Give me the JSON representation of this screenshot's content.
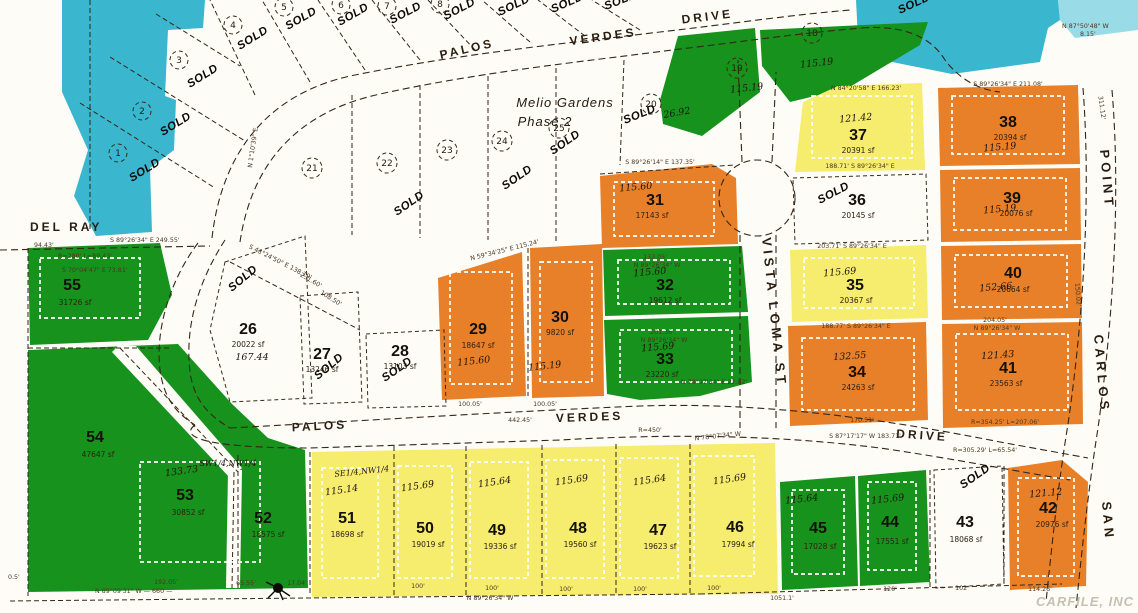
{
  "colors": {
    "water": "#3ab6ce",
    "water_light": "#9adbe8",
    "green": "#17921c",
    "yellow": "#f6ec6e",
    "orange": "#e8802a",
    "paper": "#fdfcf7"
  },
  "labels": {
    "sold": "SOLD",
    "melio1": "Melio Gardens",
    "melio2": "Phase 2",
    "q_sw": "SW1/4,NW1/4",
    "q_se": "SE1/4,NW1/4",
    "hand20": "26.92",
    "watermark": "CARFILE, INC"
  },
  "streets": {
    "top_palos": "PALOS",
    "top_verdes": "VERDES",
    "top_drive": "DRIVE",
    "del_ray": "DEL RAY",
    "mid_palos": "PALOS",
    "mid_verdes": "VERDES",
    "mid_drive": "DRIVE",
    "vista_loma": "VISTA LOMA ST",
    "san": "SAN",
    "carlos": "CARLOS",
    "point": "POINT"
  },
  "lots": [
    {
      "num": "26",
      "area": "20022 sf",
      "hand": "167.44",
      "sold": true
    },
    {
      "num": "27",
      "area": "13246 sf",
      "sold": true
    },
    {
      "num": "28",
      "area": "13103 sf",
      "sold": true
    },
    {
      "num": "29",
      "area": "18647 sf",
      "hand": "115.60"
    },
    {
      "num": "30",
      "area": "9820 sf",
      "hand": "115.19"
    },
    {
      "num": "31",
      "area": "17143 sf",
      "hand": "115.60"
    },
    {
      "num": "32",
      "area": "19612 sf",
      "hand": "115.60"
    },
    {
      "num": "33",
      "area": "23220 sf",
      "hand": "115.69"
    },
    {
      "num": "34",
      "area": "24263 sf",
      "hand": "132.55"
    },
    {
      "num": "35",
      "area": "20367 sf",
      "hand": "115.69"
    },
    {
      "num": "36",
      "area": "20145 sf",
      "sold": true
    },
    {
      "num": "37",
      "area": "20391 sf",
      "hand": "121.42"
    },
    {
      "num": "38",
      "area": "20394 sf",
      "hand": "115.19"
    },
    {
      "num": "39",
      "area": "20076 sf",
      "hand": "115.19"
    },
    {
      "num": "40",
      "area": "20664 sf",
      "hand": "152.66"
    },
    {
      "num": "41",
      "area": "23563 sf",
      "hand": "121.43"
    },
    {
      "num": "42",
      "area": "20976 sf",
      "hand": "121.12"
    },
    {
      "num": "43",
      "area": "18068 sf",
      "sold": true
    },
    {
      "num": "44",
      "area": "17551 sf",
      "hand": "115.69"
    },
    {
      "num": "45",
      "area": "17028 sf",
      "hand": "115.64"
    },
    {
      "num": "46",
      "area": "17994 sf",
      "hand": "115.69"
    },
    {
      "num": "47",
      "area": "19623 sf",
      "hand": "115.64"
    },
    {
      "num": "48",
      "area": "19560 sf",
      "hand": "115.69"
    },
    {
      "num": "49",
      "area": "19336 sf",
      "hand": "115.64"
    },
    {
      "num": "50",
      "area": "19019 sf",
      "hand": "115.69"
    },
    {
      "num": "51",
      "area": "18698 sf",
      "hand": "115.14"
    },
    {
      "num": "52",
      "area": "18575 sf"
    },
    {
      "num": "53",
      "area": "30852 sf",
      "hand": "133.73"
    },
    {
      "num": "54",
      "area": "47647 sf"
    },
    {
      "num": "55",
      "area": "31726 sf"
    },
    {
      "num": "18",
      "hand": "115.19",
      "circled": true
    },
    {
      "num": "19",
      "hand": "115.19",
      "circled": true
    },
    {
      "num": "20",
      "circled": true,
      "sold": true
    },
    {
      "num": "21",
      "circled": true
    },
    {
      "num": "22",
      "circled": true
    },
    {
      "num": "23",
      "circled": true
    },
    {
      "num": "24",
      "circled": true
    },
    {
      "num": "25",
      "circled": true
    },
    {
      "num": "1",
      "circled": true,
      "sold": true
    },
    {
      "num": "2",
      "circled": true,
      "sold": true
    },
    {
      "num": "3",
      "circled": true,
      "sold": true
    },
    {
      "num": "4",
      "circled": true,
      "sold": true
    },
    {
      "num": "5",
      "circled": true,
      "sold": true
    },
    {
      "num": "6",
      "circled": true,
      "sold": true
    },
    {
      "num": "7",
      "circled": true,
      "sold": true
    },
    {
      "num": "8",
      "circled": true,
      "sold": true
    }
  ],
  "bearings": [
    "S 89°26'34\" E   211.08'",
    "N 87°50'48\" W",
    "8.15'",
    "N 84°20'58\" E   166.23'",
    "S 89°26'14\" E   137.35'",
    "133.05'",
    "N 89°26'34\" W",
    "201.36'",
    "N 89°26'34\" W",
    "N 78°07'34\" E  22.02'",
    "S 89°26'34\" E   249.55'",
    "S 43°24'50\" E  138.19'",
    "231.60'",
    "108.50'",
    "N 89°09'31\" W   — 660 —",
    "N 89°26'34\" W",
    "100.05'",
    "100.05'",
    "442.45'",
    "R=450'",
    "N 78°07'34\" W",
    "R=354.25'  L=207.06'",
    "S 87°17'17\" W  183.71'",
    "R=305.29'  L=65.54'",
    "204.05'",
    "N 89°26'34\" W",
    "203.71'  S 89°26'34\" E",
    "188.77'  S 89°26'34\" E",
    "188.71'  S 89°26'34\" E",
    "170.51'",
    "N 59°34'25\" E  115.24'",
    "311.12'",
    "150.02'",
    "R=280'  L=89.43'",
    "S 70°04'47\" E  73.81'",
    "94.43'",
    "N 1°10'39\" E"
  ],
  "dims": [
    "100'",
    "120'",
    "102'",
    "114.26'",
    "1051.1'",
    "192.05'",
    "65.55'",
    "17.04'",
    "0.5'"
  ]
}
